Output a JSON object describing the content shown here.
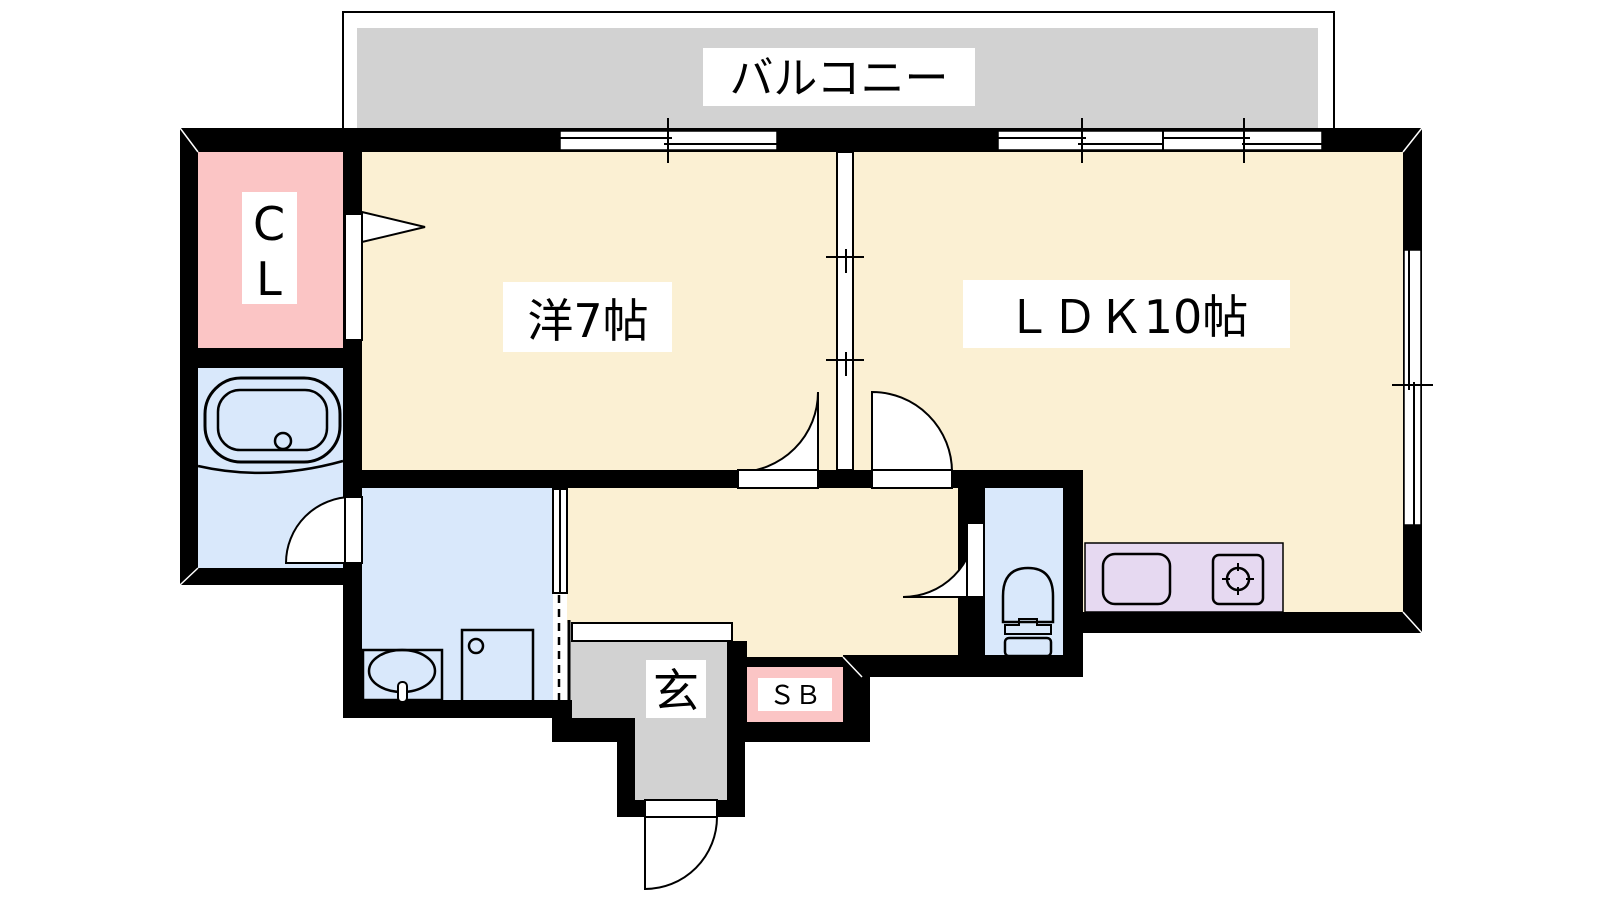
{
  "plan": {
    "labels": {
      "balcony": "バルコニー",
      "western_room": "洋7帖",
      "ldk": "ＬＤＫ10帖",
      "closet_top": "C",
      "closet_bottom": "L",
      "entrance": "玄",
      "shoe_box": "ＳＢ"
    },
    "colors": {
      "floor_cream": "#FBF0D3",
      "balcony_gray": "#D2D2D2",
      "entrance_gray": "#D2D2D2",
      "closet_pink": "#FBC5C5",
      "shoebox_pink": "#FBC5C5",
      "wet_area_blue": "#D9E8FB",
      "kitchen_purple": "#E6D9F1",
      "wall": "#000000",
      "label_bg": "#FFFFFF",
      "label_text": "#000000"
    }
  }
}
